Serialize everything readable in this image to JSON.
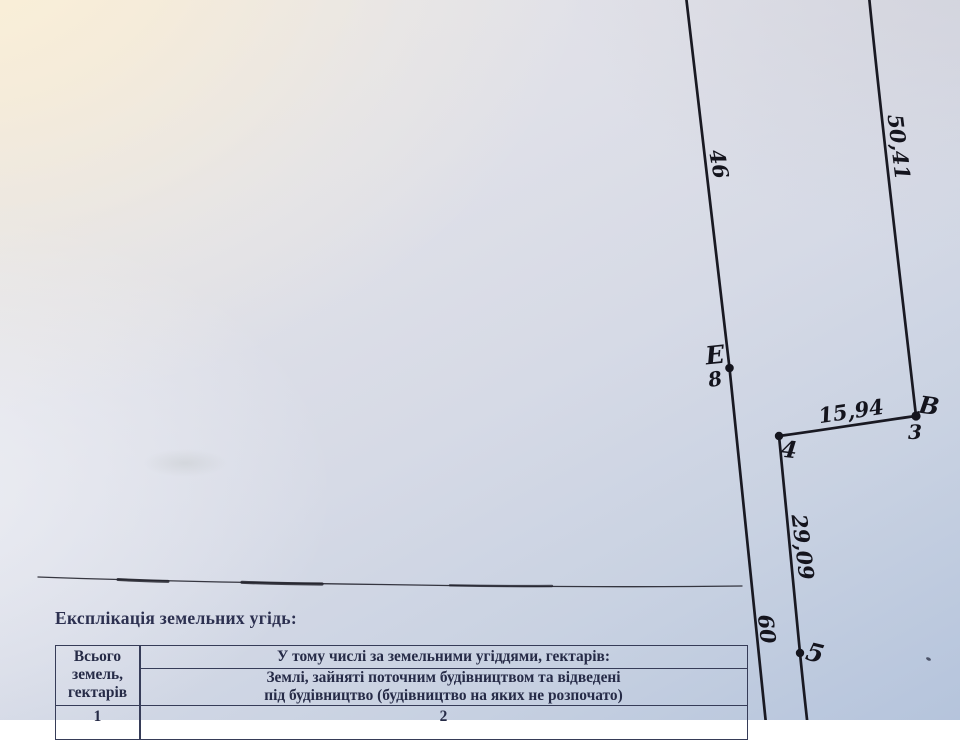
{
  "document": {
    "title": "Експлікація земельних угідь:",
    "table": {
      "col1_header_line1": "Всього",
      "col1_header_line2": "земель,",
      "col1_header_line3": "гектарів",
      "col2_header": "У тому числі за земельними угіддями, гектарів:",
      "col2_subheader_line1": "Землі, зайняті поточним будівництвом та відведені",
      "col2_subheader_line2": "під будівництво (будівництво на яких не розпочато)",
      "row_col1_value": "1",
      "row_col2_value": "2"
    }
  },
  "plan": {
    "dimension_labels": [
      {
        "id": "segment-46",
        "text": "46"
      },
      {
        "id": "segment-50-41",
        "text": "50,41"
      },
      {
        "id": "segment-15-94",
        "text": "15,94"
      },
      {
        "id": "segment-29-09",
        "text": "29,09"
      },
      {
        "id": "segment-60",
        "text": "60"
      }
    ],
    "point_labels": [
      {
        "id": "point-E",
        "text": "Е"
      },
      {
        "id": "point-8",
        "text": "8"
      },
      {
        "id": "point-V",
        "text": "В"
      },
      {
        "id": "point-3",
        "text": "3"
      },
      {
        "id": "point-4",
        "text": "4"
      },
      {
        "id": "point-5",
        "text": "5"
      }
    ],
    "colors": {
      "ink": "#14141d",
      "print_text": "#262b47",
      "paper_warm": "#f6ecd7",
      "paper_cool": "#b5c4dc"
    }
  }
}
